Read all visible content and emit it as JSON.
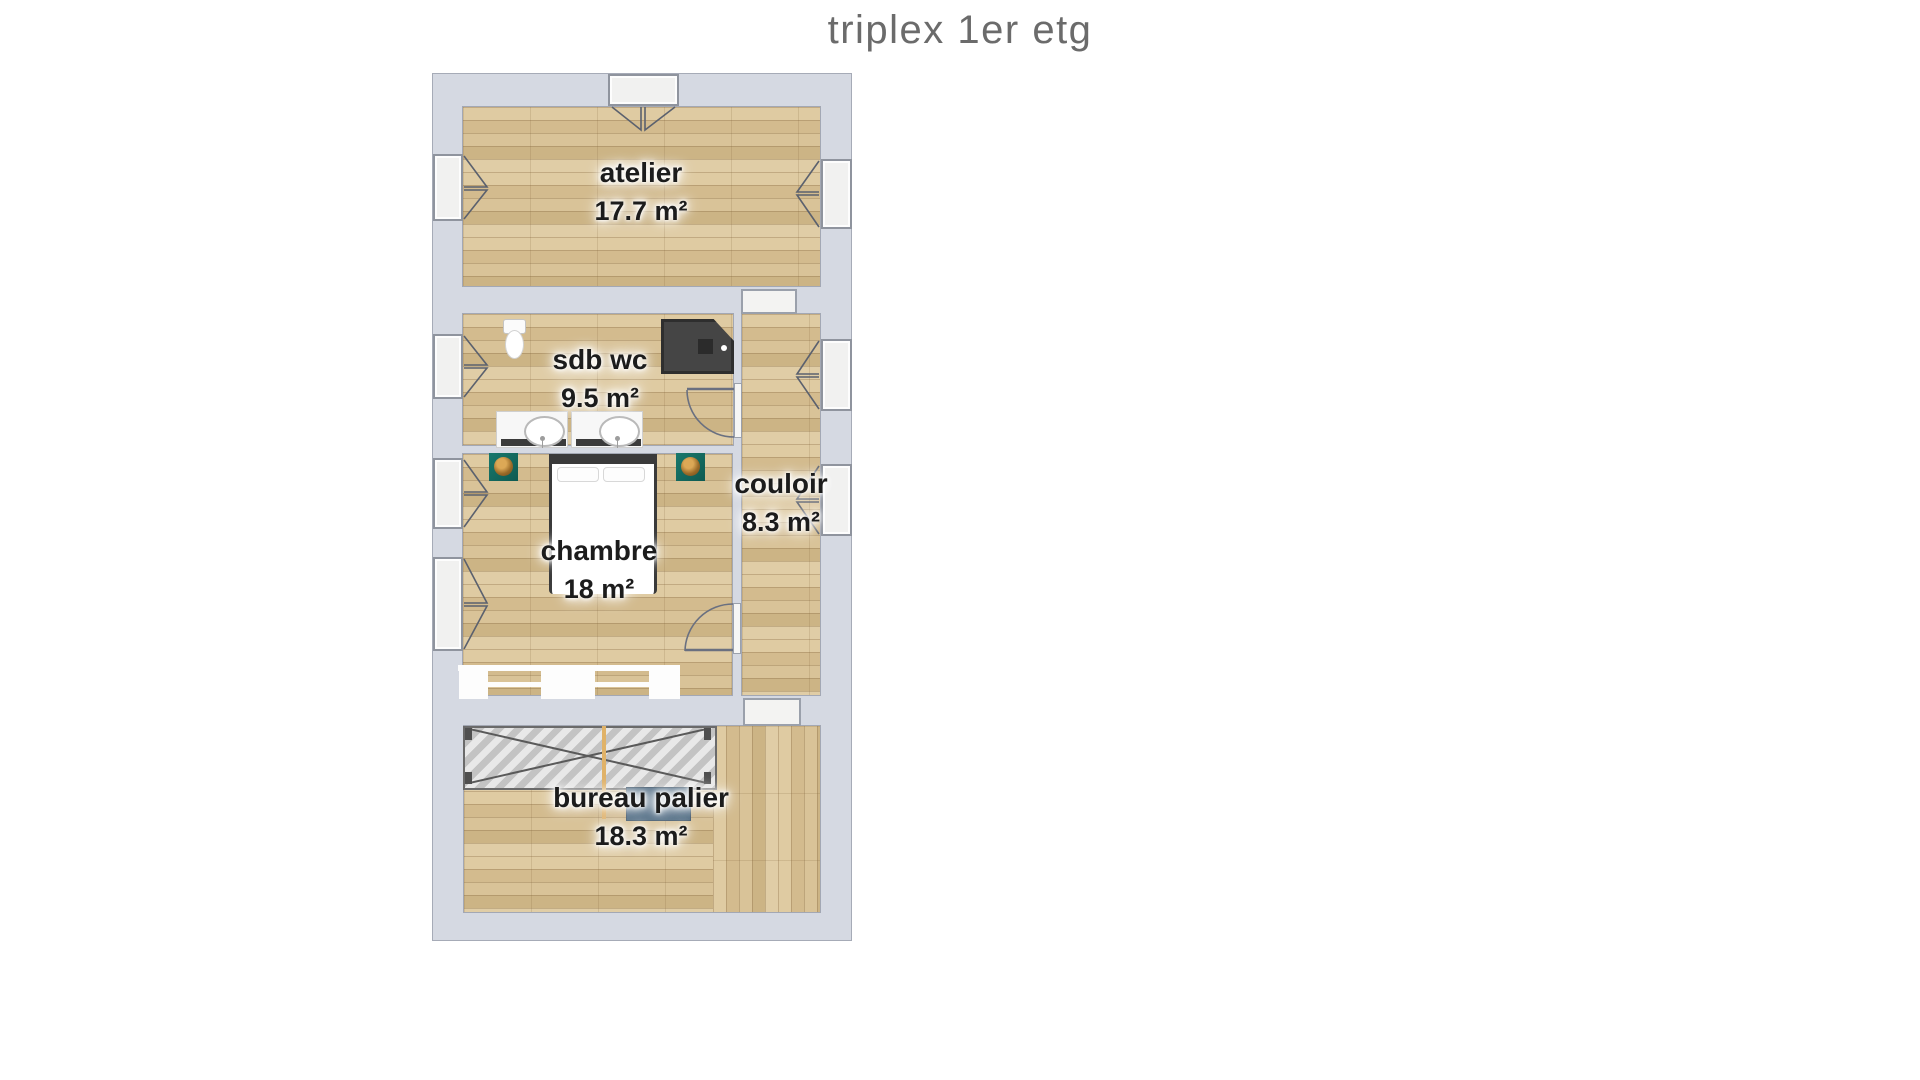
{
  "title": "triplex 1er etg",
  "rooms": [
    {
      "name": "atelier",
      "area": "17.7 m²"
    },
    {
      "name": "sdb wc",
      "area": "9.5 m²"
    },
    {
      "name": "couloir",
      "area": "8.3 m²"
    },
    {
      "name": "chambre",
      "area": "18 m²"
    },
    {
      "name": "bureau palier",
      "area": "18.3 m²"
    }
  ],
  "fixtures": {
    "bathroom": [
      "toilet",
      "shower",
      "double-vanity-sinks"
    ],
    "bedroom": [
      "double-bed",
      "nightstand-left",
      "nightstand-right",
      "wardrobe"
    ],
    "office": [
      "stair-opening-hatch",
      "handrail-pole",
      "desk"
    ]
  },
  "openings": {
    "windows": 8,
    "doors": [
      "sdb-to-couloir",
      "chambre-to-couloir",
      "atelier-to-couloir-passage",
      "couloir-to-bureau-passage"
    ]
  },
  "colors": {
    "wall": "#d5d9e2",
    "wall_outline": "#a6abb7",
    "floor_light": "#dfcba2",
    "floor_dark": "#ccb485",
    "window_fill": "#f1f1f0",
    "label_text": "#1c1c1c",
    "title_text": "#6b6b6b",
    "shower": "#454545",
    "nightstand_teal": "#147064",
    "desk_blue": "#4a6780",
    "hatch_border": "#6a6a6a"
  }
}
